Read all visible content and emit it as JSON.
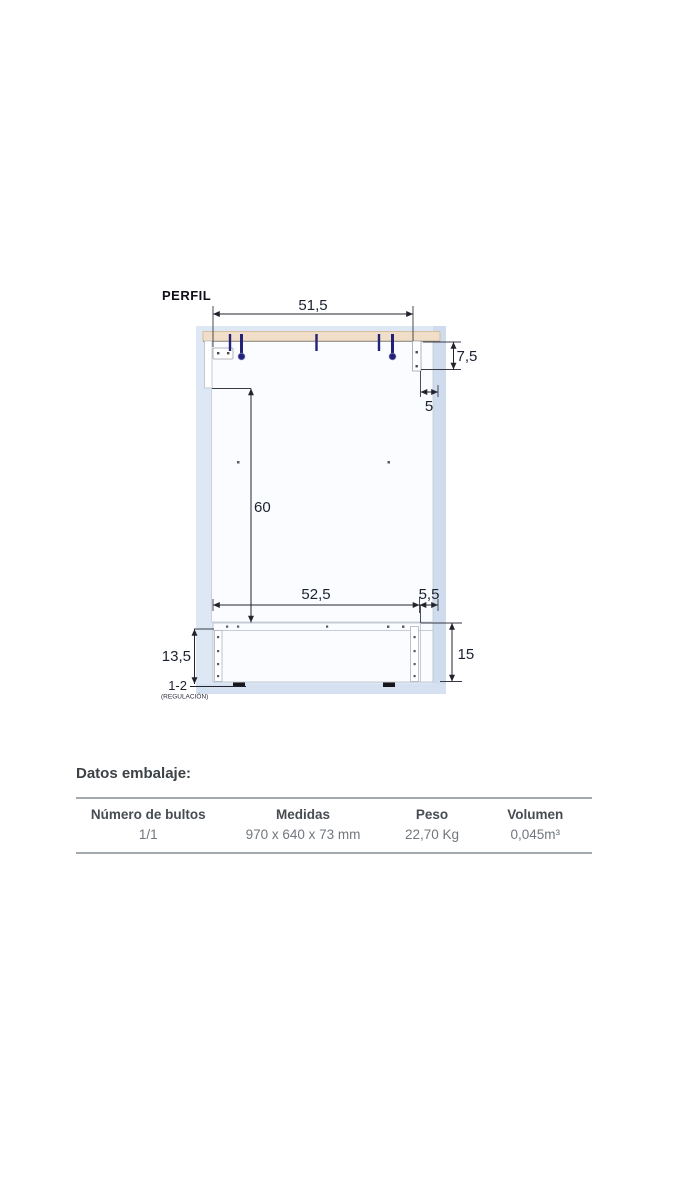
{
  "diagram": {
    "title": "PERFIL",
    "dims": {
      "top_width": "51,5",
      "top_thickness": "7,5",
      "top_back_inset": "5",
      "side_height": "60",
      "bottom_width": "52,5",
      "bottom_back_inset": "5,5",
      "plinth_front": "13,5",
      "plinth_back": "15",
      "feet_range": "1-2",
      "feet_note": "(REGULACIÓN)"
    },
    "colors": {
      "backdrop_blue": "#dee8f5",
      "wood_tan": "#f1dec8",
      "pin_navy": "#232178",
      "panel_white": "#fbfcff"
    }
  },
  "packing": {
    "title": "Datos embalaje:",
    "columns": [
      "Número de bultos",
      "Medidas",
      "Peso",
      "Volumen"
    ],
    "values": [
      "1/1",
      "970 x 640 x 73 mm",
      "22,70 Kg",
      "0,045m³"
    ]
  }
}
